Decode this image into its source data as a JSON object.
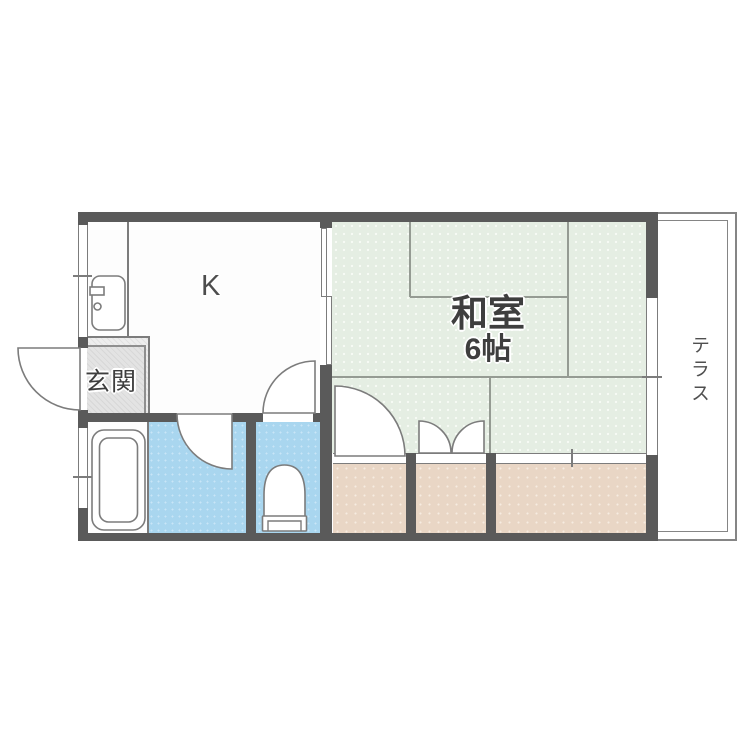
{
  "floorplan": {
    "labels": {
      "kitchen": "K",
      "entrance": "玄関",
      "tatami_room_name": "和室",
      "tatami_room_size": "6帖",
      "terrace": "テラス"
    },
    "colors": {
      "wall": "#5a5a5a",
      "line": "#7c7c7c",
      "tatami": "#e5eee3",
      "water": "#a9d6ef",
      "closet": "#e9d6c5",
      "genkan": "#ededed",
      "text": "#3e3e3e"
    }
  }
}
